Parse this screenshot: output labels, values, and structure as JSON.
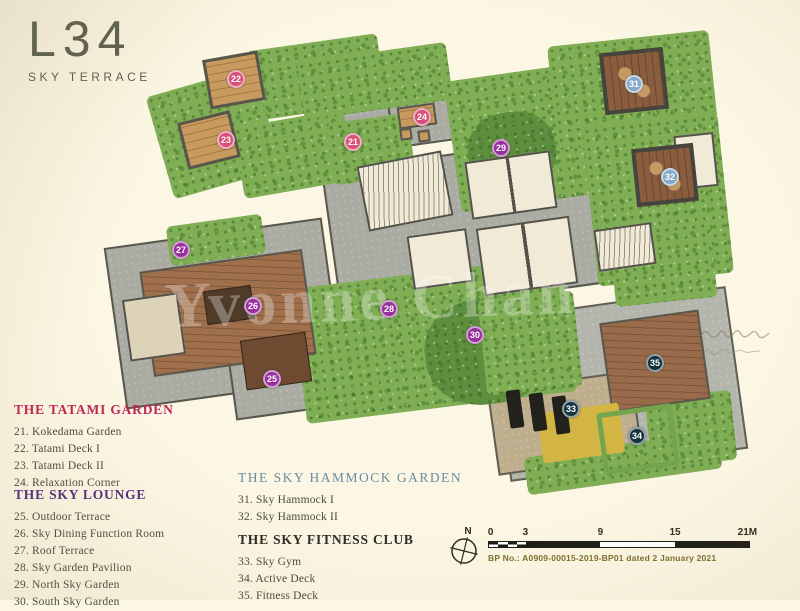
{
  "title": {
    "level": "L34",
    "subtitle": "SKY TERRACE"
  },
  "legend": {
    "sections": [
      {
        "id": "tatami-garden",
        "heading": "THE TATAMI GARDEN",
        "color": "#bf2455",
        "items": [
          {
            "no": "21",
            "label": "Kokedama Garden"
          },
          {
            "no": "22",
            "label": "Tatami Deck I"
          },
          {
            "no": "23",
            "label": "Tatami Deck II"
          },
          {
            "no": "24",
            "label": "Relaxation Corner"
          }
        ]
      },
      {
        "id": "sky-lounge",
        "heading": "THE SKY LOUNGE",
        "color": "#522d7d",
        "items": [
          {
            "no": "25",
            "label": "Outdoor Terrace"
          },
          {
            "no": "26",
            "label": "Sky Dining Function Room"
          },
          {
            "no": "27",
            "label": "Roof Terrace"
          },
          {
            "no": "28",
            "label": "Sky Garden Pavilion"
          },
          {
            "no": "29",
            "label": "North Sky Garden"
          },
          {
            "no": "30",
            "label": "South Sky Garden"
          }
        ]
      },
      {
        "id": "sky-hammock-garden",
        "heading": "THE SKY HAMMOCK GARDEN",
        "color": "#6a8da0",
        "items": [
          {
            "no": "31",
            "label": "Sky Hammock I"
          },
          {
            "no": "32",
            "label": "Sky Hammock II"
          }
        ]
      },
      {
        "id": "sky-fitness-club",
        "heading": "THE SKY FITNESS CLUB",
        "color": "#2e2b25",
        "items": [
          {
            "no": "33",
            "label": "Sky Gym"
          },
          {
            "no": "34",
            "label": "Active Deck"
          },
          {
            "no": "35",
            "label": "Fitness Deck"
          }
        ]
      }
    ]
  },
  "plan": {
    "marker_colors": {
      "tatami-garden": "#d85077",
      "sky-lounge": "#97309b",
      "sky-hammock-garden": "#85a8c6",
      "sky-fitness-club": "#14343f"
    },
    "markers": [
      {
        "no": "21",
        "x": 353,
        "y": 142,
        "group": "tatami-garden"
      },
      {
        "no": "22",
        "x": 236,
        "y": 79,
        "group": "tatami-garden"
      },
      {
        "no": "23",
        "x": 226,
        "y": 140,
        "group": "tatami-garden"
      },
      {
        "no": "24",
        "x": 422,
        "y": 117,
        "group": "tatami-garden"
      },
      {
        "no": "25",
        "x": 272,
        "y": 379,
        "group": "sky-lounge"
      },
      {
        "no": "26",
        "x": 253,
        "y": 306,
        "group": "sky-lounge"
      },
      {
        "no": "27",
        "x": 181,
        "y": 250,
        "group": "sky-lounge"
      },
      {
        "no": "28",
        "x": 389,
        "y": 309,
        "group": "sky-lounge"
      },
      {
        "no": "29",
        "x": 501,
        "y": 148,
        "group": "sky-lounge"
      },
      {
        "no": "30",
        "x": 475,
        "y": 335,
        "group": "sky-lounge"
      },
      {
        "no": "31",
        "x": 634,
        "y": 84,
        "group": "sky-hammock-garden"
      },
      {
        "no": "32",
        "x": 670,
        "y": 177,
        "group": "sky-hammock-garden"
      },
      {
        "no": "33",
        "x": 571,
        "y": 409,
        "group": "sky-fitness-club"
      },
      {
        "no": "34",
        "x": 637,
        "y": 436,
        "group": "sky-fitness-club"
      },
      {
        "no": "35",
        "x": 655,
        "y": 363,
        "group": "sky-fitness-club"
      }
    ]
  },
  "compass": {
    "label": "N"
  },
  "scale_bar": {
    "labels": [
      "0",
      "3",
      "9",
      "15",
      "21M"
    ]
  },
  "footer": {
    "bp_text": "BP No.: A0909-00015-2019-BP01 dated 2 January 2021"
  },
  "watermark": {
    "text": "Yvonne Chan"
  }
}
